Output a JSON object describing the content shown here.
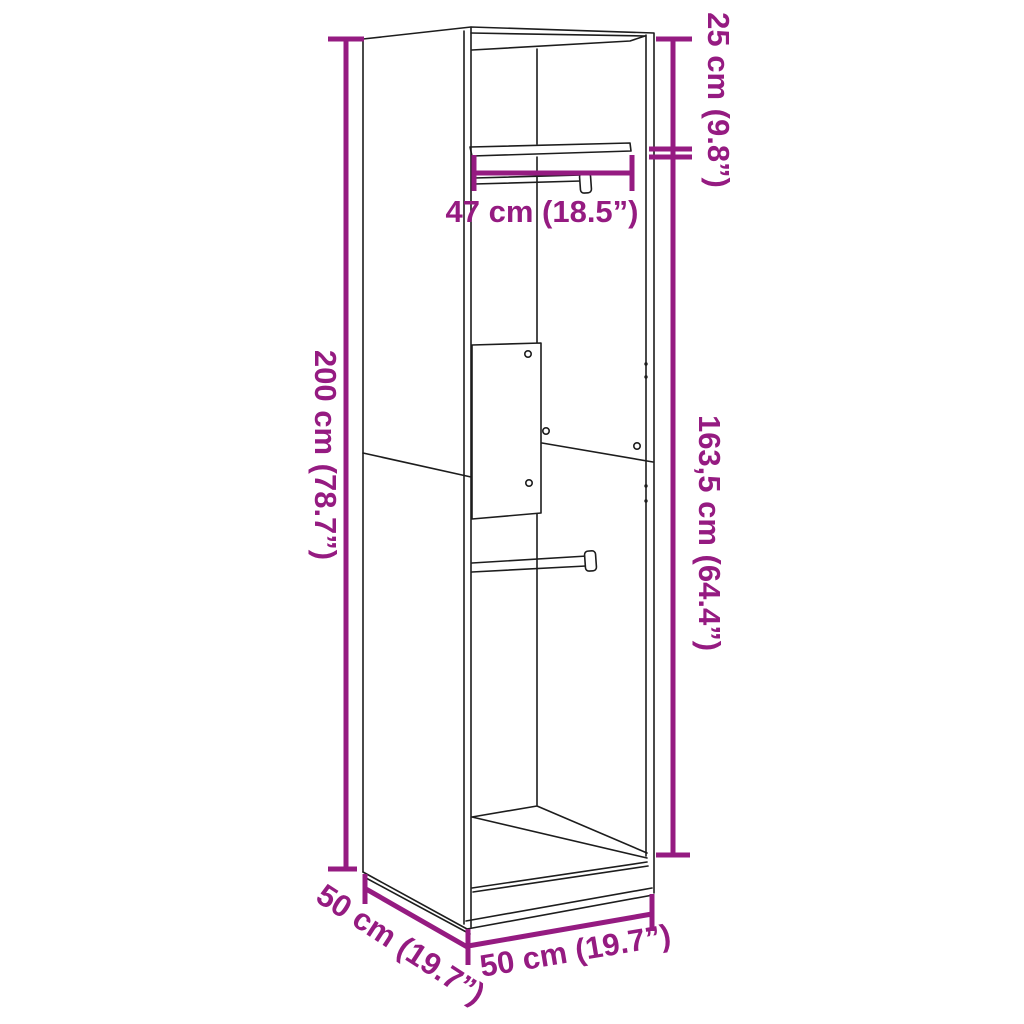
{
  "diagram": {
    "type": "furniture-dimension-diagram",
    "subject": "wardrobe-line-drawing",
    "colors": {
      "dimension_accent": "#951b81",
      "outline": "#1d1d1d",
      "background": "#ffffff"
    },
    "labels": {
      "top_section_height": "25 cm (9.8”)",
      "inner_width": "47 cm (18.5”)",
      "total_height": "200 cm (78.7”)",
      "lower_section_height": "163,5 cm (64.4”)",
      "depth": "50 cm (19.7”)",
      "width": "50 cm (19.7”)"
    },
    "measurements": [
      {
        "id": "top-section-height",
        "value_cm": "25",
        "value_inch": "9.8",
        "label": "25 cm (9.8”)",
        "orientation": "vertical-right-top"
      },
      {
        "id": "inner-width",
        "value_cm": "47",
        "value_inch": "18.5",
        "label": "47 cm (18.5”)",
        "orientation": "horizontal-shelf"
      },
      {
        "id": "total-height",
        "value_cm": "200",
        "value_inch": "78.7",
        "label": "200 cm (78.7”)",
        "orientation": "vertical-left"
      },
      {
        "id": "lower-section-height",
        "value_cm": "163,5",
        "value_inch": "64.4",
        "label": "163,5 cm (64.4”)",
        "orientation": "vertical-right-bottom"
      },
      {
        "id": "depth",
        "value_cm": "50",
        "value_inch": "19.7",
        "label": "50 cm (19.7”)",
        "orientation": "diagonal-bottom-left"
      },
      {
        "id": "width",
        "value_cm": "50",
        "value_inch": "19.7",
        "label": "50 cm (19.7”)",
        "orientation": "diagonal-bottom-front"
      }
    ]
  }
}
